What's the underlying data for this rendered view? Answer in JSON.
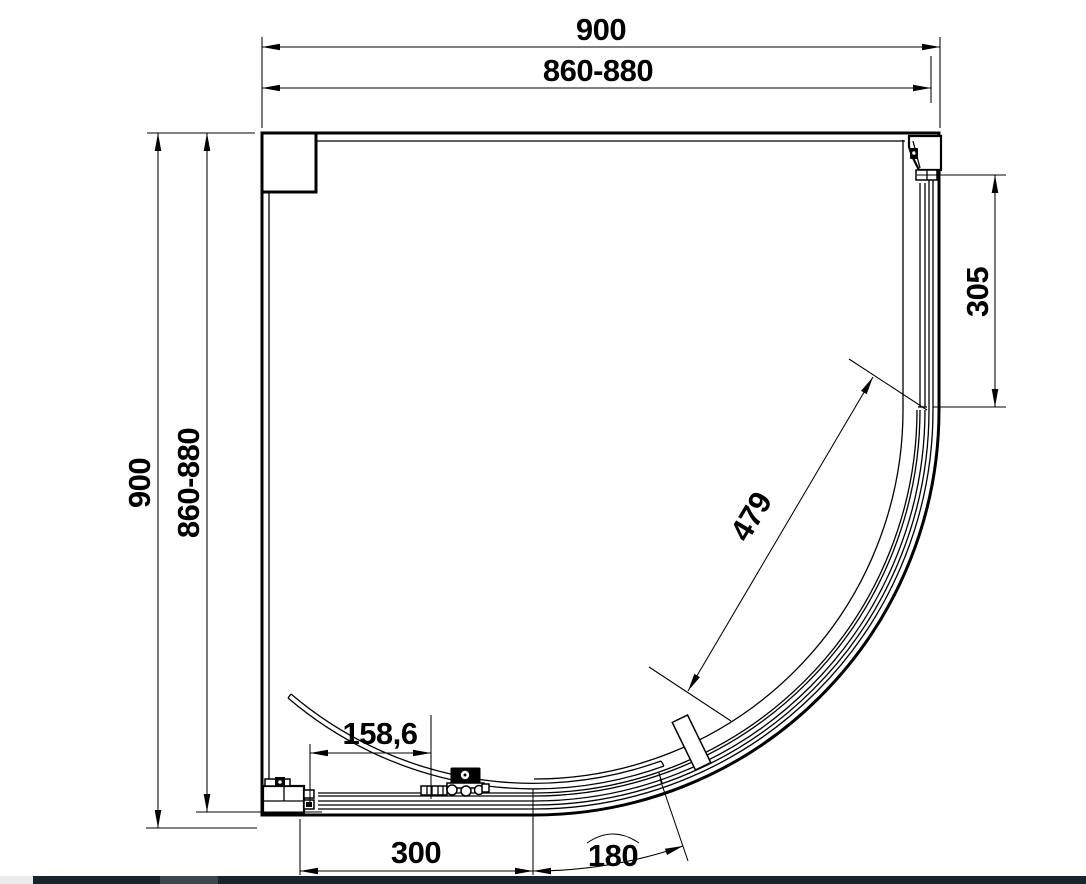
{
  "page": {
    "background": "#ffffff",
    "line_color": "#000000"
  },
  "drawing": {
    "dimensions": {
      "width_overall": "900",
      "width_adjustment": "860-880",
      "height_overall": "900",
      "height_adjustment": "860-880",
      "side_panel_length": "305",
      "door_opening_diagonal": "479",
      "handle_offset": "158,6",
      "front_panel_length": "300",
      "arc_segment_length": "180"
    }
  },
  "taskbar": {
    "bar_color": "#18242c",
    "segment_color": "#3b464d",
    "left_gap_color": "#ececec"
  }
}
